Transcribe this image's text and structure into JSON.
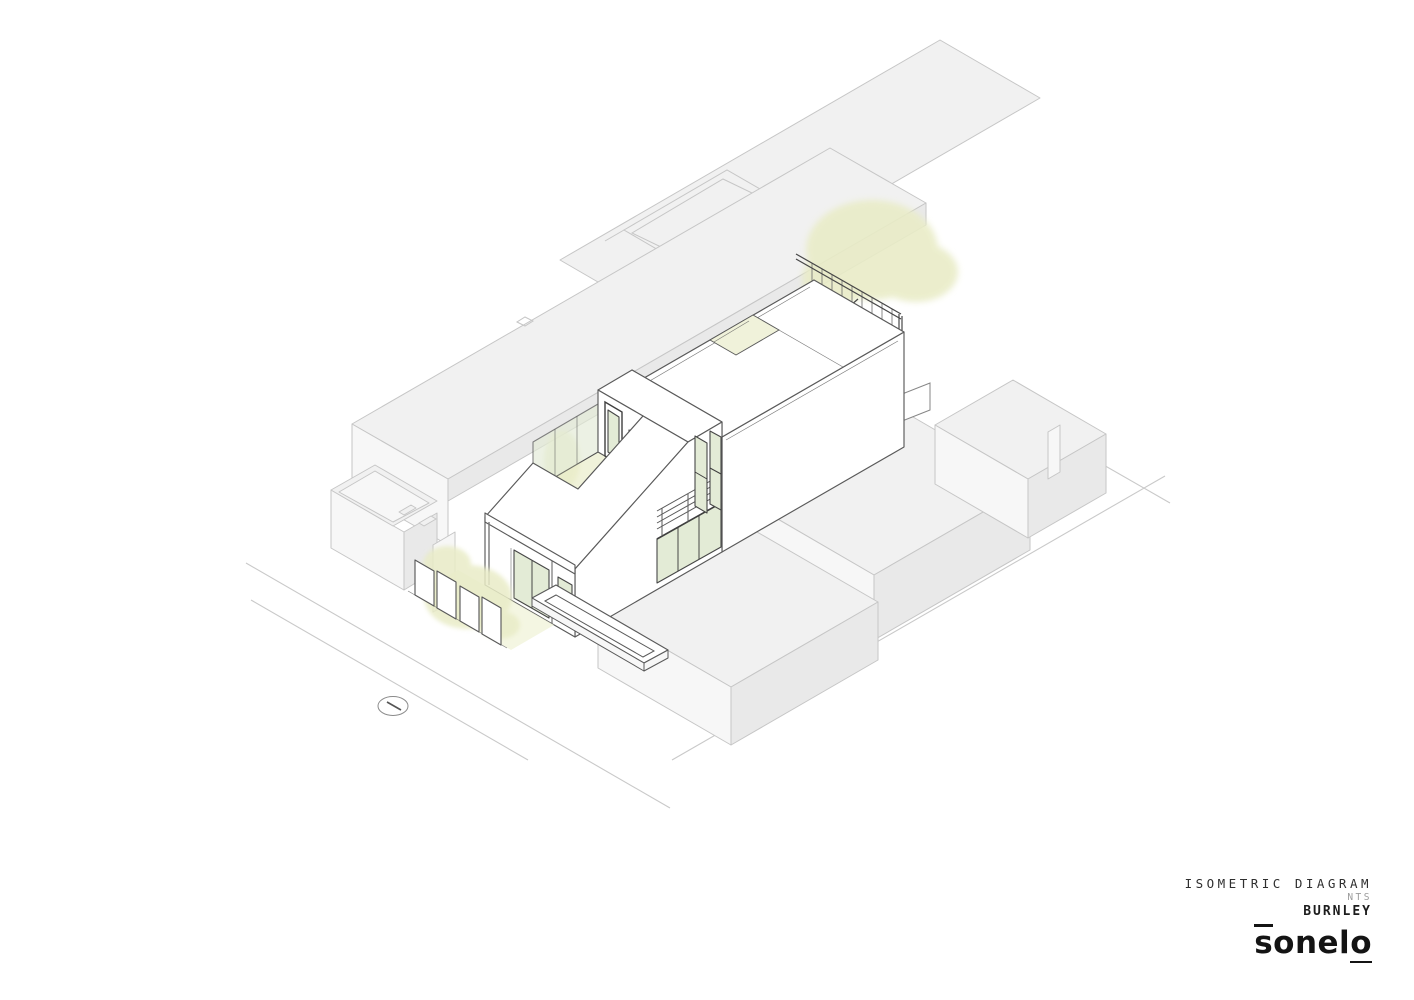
{
  "title_block": {
    "line1": "ISOMETRIC DIAGRAM",
    "line2": "NTS",
    "line3": "BURNLEY",
    "logo": "sonelo"
  },
  "icons": {
    "north_arrow": "ellipse-compass-with-needle"
  },
  "colors": {
    "paper": "#ffffff",
    "subject_line": "#5a5a5a",
    "frame_line": "#474747",
    "context_line": "#c6c6c6",
    "context_fill": "#f1f1f1",
    "context_fill_dark": "#e9e9e9",
    "context_fill_light": "#f7f7f7",
    "glass": "#e3ebd6",
    "foliage": "#e9ecc7",
    "courtyard": "#f0f2da",
    "street_line": "#c9c9c9",
    "dark_fill": "#9da1a0",
    "text_primary": "#2f2f2f",
    "text_muted": "#9b9b9b",
    "text_strong": "#1d1d1d",
    "logo": "#141414"
  }
}
